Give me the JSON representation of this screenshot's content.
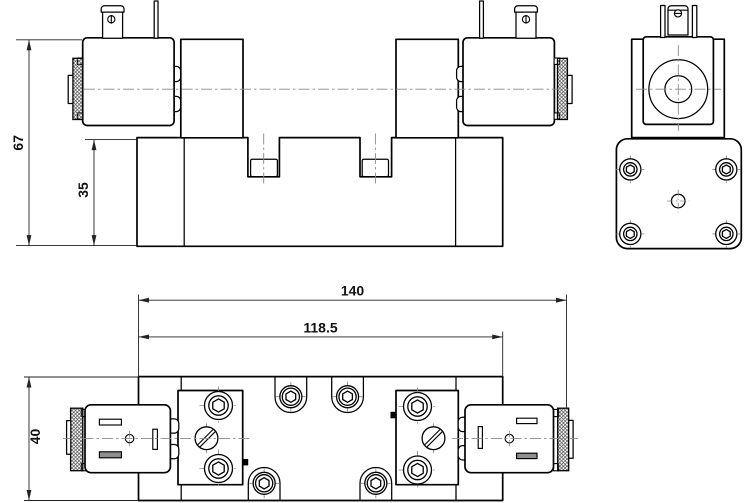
{
  "drawing": {
    "kind": "technical-drawing",
    "views": {
      "front": "front-view",
      "side": "side-view",
      "plan": "plan-view"
    }
  },
  "dimensions": {
    "front_overall_height": "67",
    "front_body_height": "35",
    "plan_overall_length": "140",
    "plan_body_length": "118.5",
    "plan_body_width": "40"
  },
  "colors": {
    "outline": "#000000",
    "dimension": "#222222",
    "centerline": "#8a8a8a",
    "slot_fill": "#8f8f8f",
    "background": "#ffffff"
  }
}
